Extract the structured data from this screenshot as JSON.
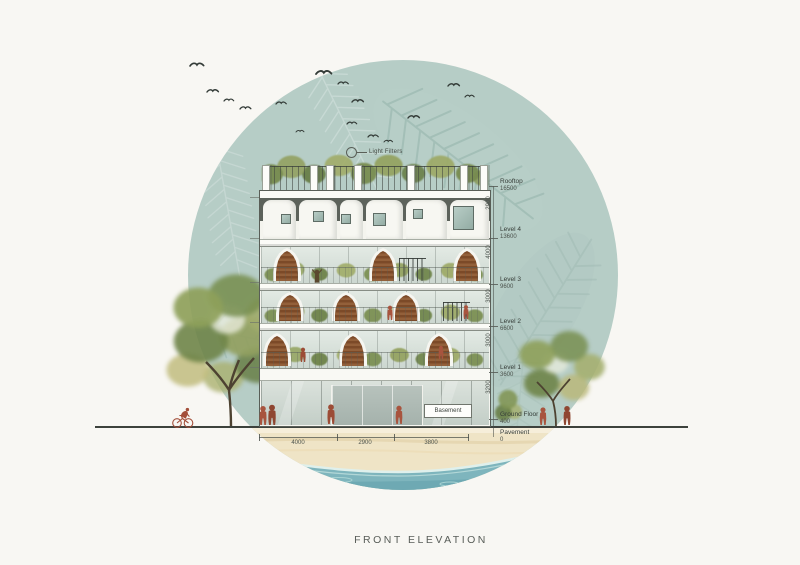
{
  "title": "FRONT ELEVATION",
  "annotations": {
    "light_filters": "Light Filters",
    "basement": "Basement"
  },
  "levels": [
    {
      "name": "Rooftop",
      "elevation": "16500"
    },
    {
      "name": "Level 4",
      "elevation": "13600"
    },
    {
      "name": "Level 3",
      "elevation": "9600"
    },
    {
      "name": "Level 2",
      "elevation": "6600"
    },
    {
      "name": "Level 1",
      "elevation": "3600"
    },
    {
      "name": "Ground Floor",
      "elevation": "400"
    },
    {
      "name": "Pavement",
      "elevation": "0"
    }
  ],
  "vertical_dims": [
    "2900",
    "4000",
    "3000",
    "3000",
    "3200"
  ],
  "horizontal_dims": [
    "4000",
    "2900",
    "3800"
  ],
  "palette": {
    "background": "#f8f7f3",
    "circle": "#b6cdc6",
    "leaf_pattern": "#92b1aa",
    "water": "#7eb5bd",
    "sand": "#efe4c6",
    "facade_white": "#f5f5f0",
    "arch_wood": "#7c4a28",
    "foliage": "#7e9458",
    "figure_red": "#a8543e",
    "line_dark": "#3d423c"
  }
}
